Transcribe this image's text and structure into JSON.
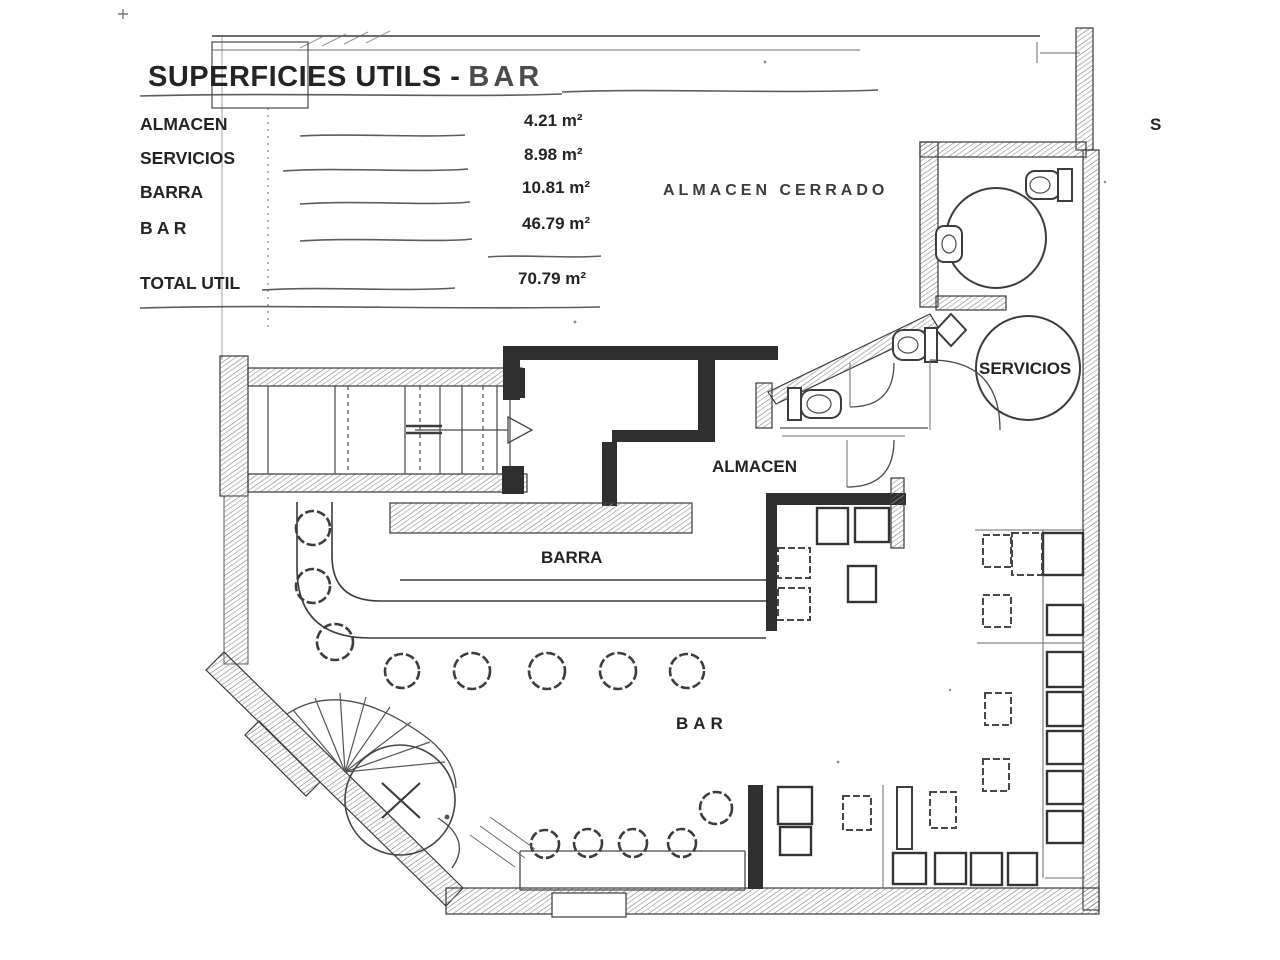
{
  "title": {
    "main": "SUPERFICIES UTILS -",
    "suffix": "BAR"
  },
  "legend": {
    "rows": [
      {
        "label": "ALMACEN",
        "value": "4.21 m²"
      },
      {
        "label": "SERVICIOS",
        "value": "8.98 m²"
      },
      {
        "label": "BARRA",
        "value": "10.81 m²"
      },
      {
        "label": "B A R",
        "value": "46.79 m²"
      }
    ],
    "total": {
      "label": "TOTAL UTIL",
      "value": "70.79 m²"
    }
  },
  "plan_labels": {
    "almacen_cerrado": "ALMACEN CERRADO",
    "servicios": "SERVICIOS",
    "almacen": "ALMACEN",
    "barra": "BARRA",
    "bar": "BAR",
    "edge_letter": "S"
  },
  "colors": {
    "ink": "#2f2f2f",
    "paper": "#ffffff",
    "faint": "#6a6a6a"
  }
}
